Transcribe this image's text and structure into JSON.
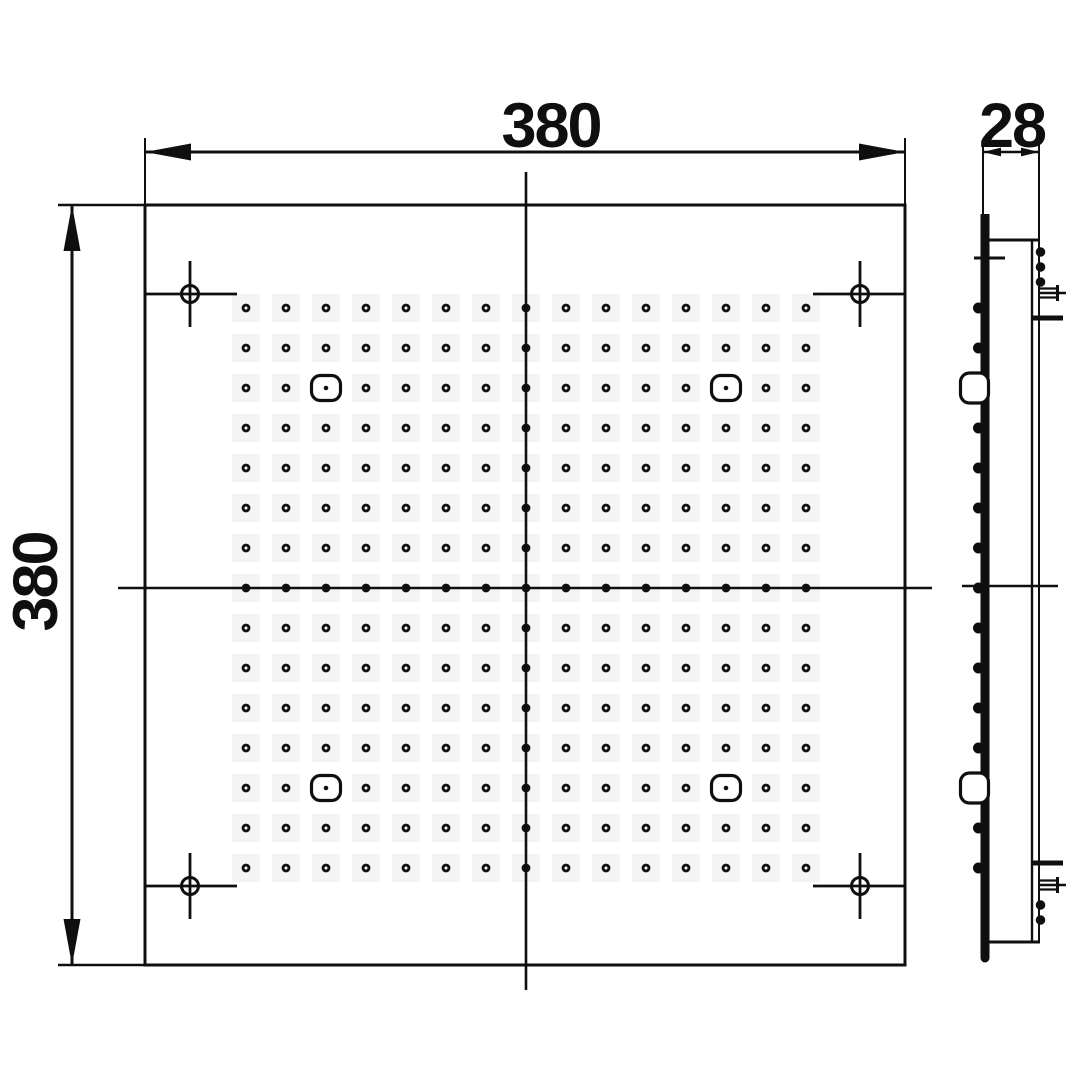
{
  "drawing": {
    "type": "technical-dimension-drawing",
    "views": {
      "front": "square shower head face with nozzle grid",
      "side": "thin profile with mounting hardware"
    },
    "dimensions": {
      "width_label": "380",
      "height_label": "380",
      "depth_label": "28"
    },
    "front_view": {
      "square": {
        "x": 145,
        "y": 205,
        "size": 760
      },
      "center": {
        "x": 526,
        "y": 588
      },
      "nozzle_grid": {
        "cols": 15,
        "rows": 15,
        "spacing": 40,
        "first_x": 246,
        "first_y": 308,
        "dot_outer_r": 4.4,
        "dot_hole_r": 1.5
      },
      "led_nozzles": [
        {
          "col": 2,
          "row": 2
        },
        {
          "col": 12,
          "row": 2
        },
        {
          "col": 2,
          "row": 12
        },
        {
          "col": 12,
          "row": 12
        }
      ],
      "mounting_marks": [
        {
          "cx": 190,
          "cy": 294,
          "edge": "left"
        },
        {
          "cx": 860,
          "cy": 294,
          "edge": "right"
        },
        {
          "cx": 190,
          "cy": 886,
          "edge": "left"
        },
        {
          "cx": 860,
          "cy": 886,
          "edge": "right"
        }
      ]
    },
    "side_view": {
      "bar_x": 985,
      "bump_x": 978.5,
      "right_bump_x": 1040.5,
      "right_bump_ys": [
        252,
        267,
        282,
        905,
        920
      ],
      "clip": {
        "x": 960.5,
        "w": 28,
        "h": 30,
        "rx": 9
      }
    },
    "colors": {
      "ink": "#0f0f0f",
      "paper": "#ffffff",
      "artifact": "#f4f4f4"
    }
  }
}
